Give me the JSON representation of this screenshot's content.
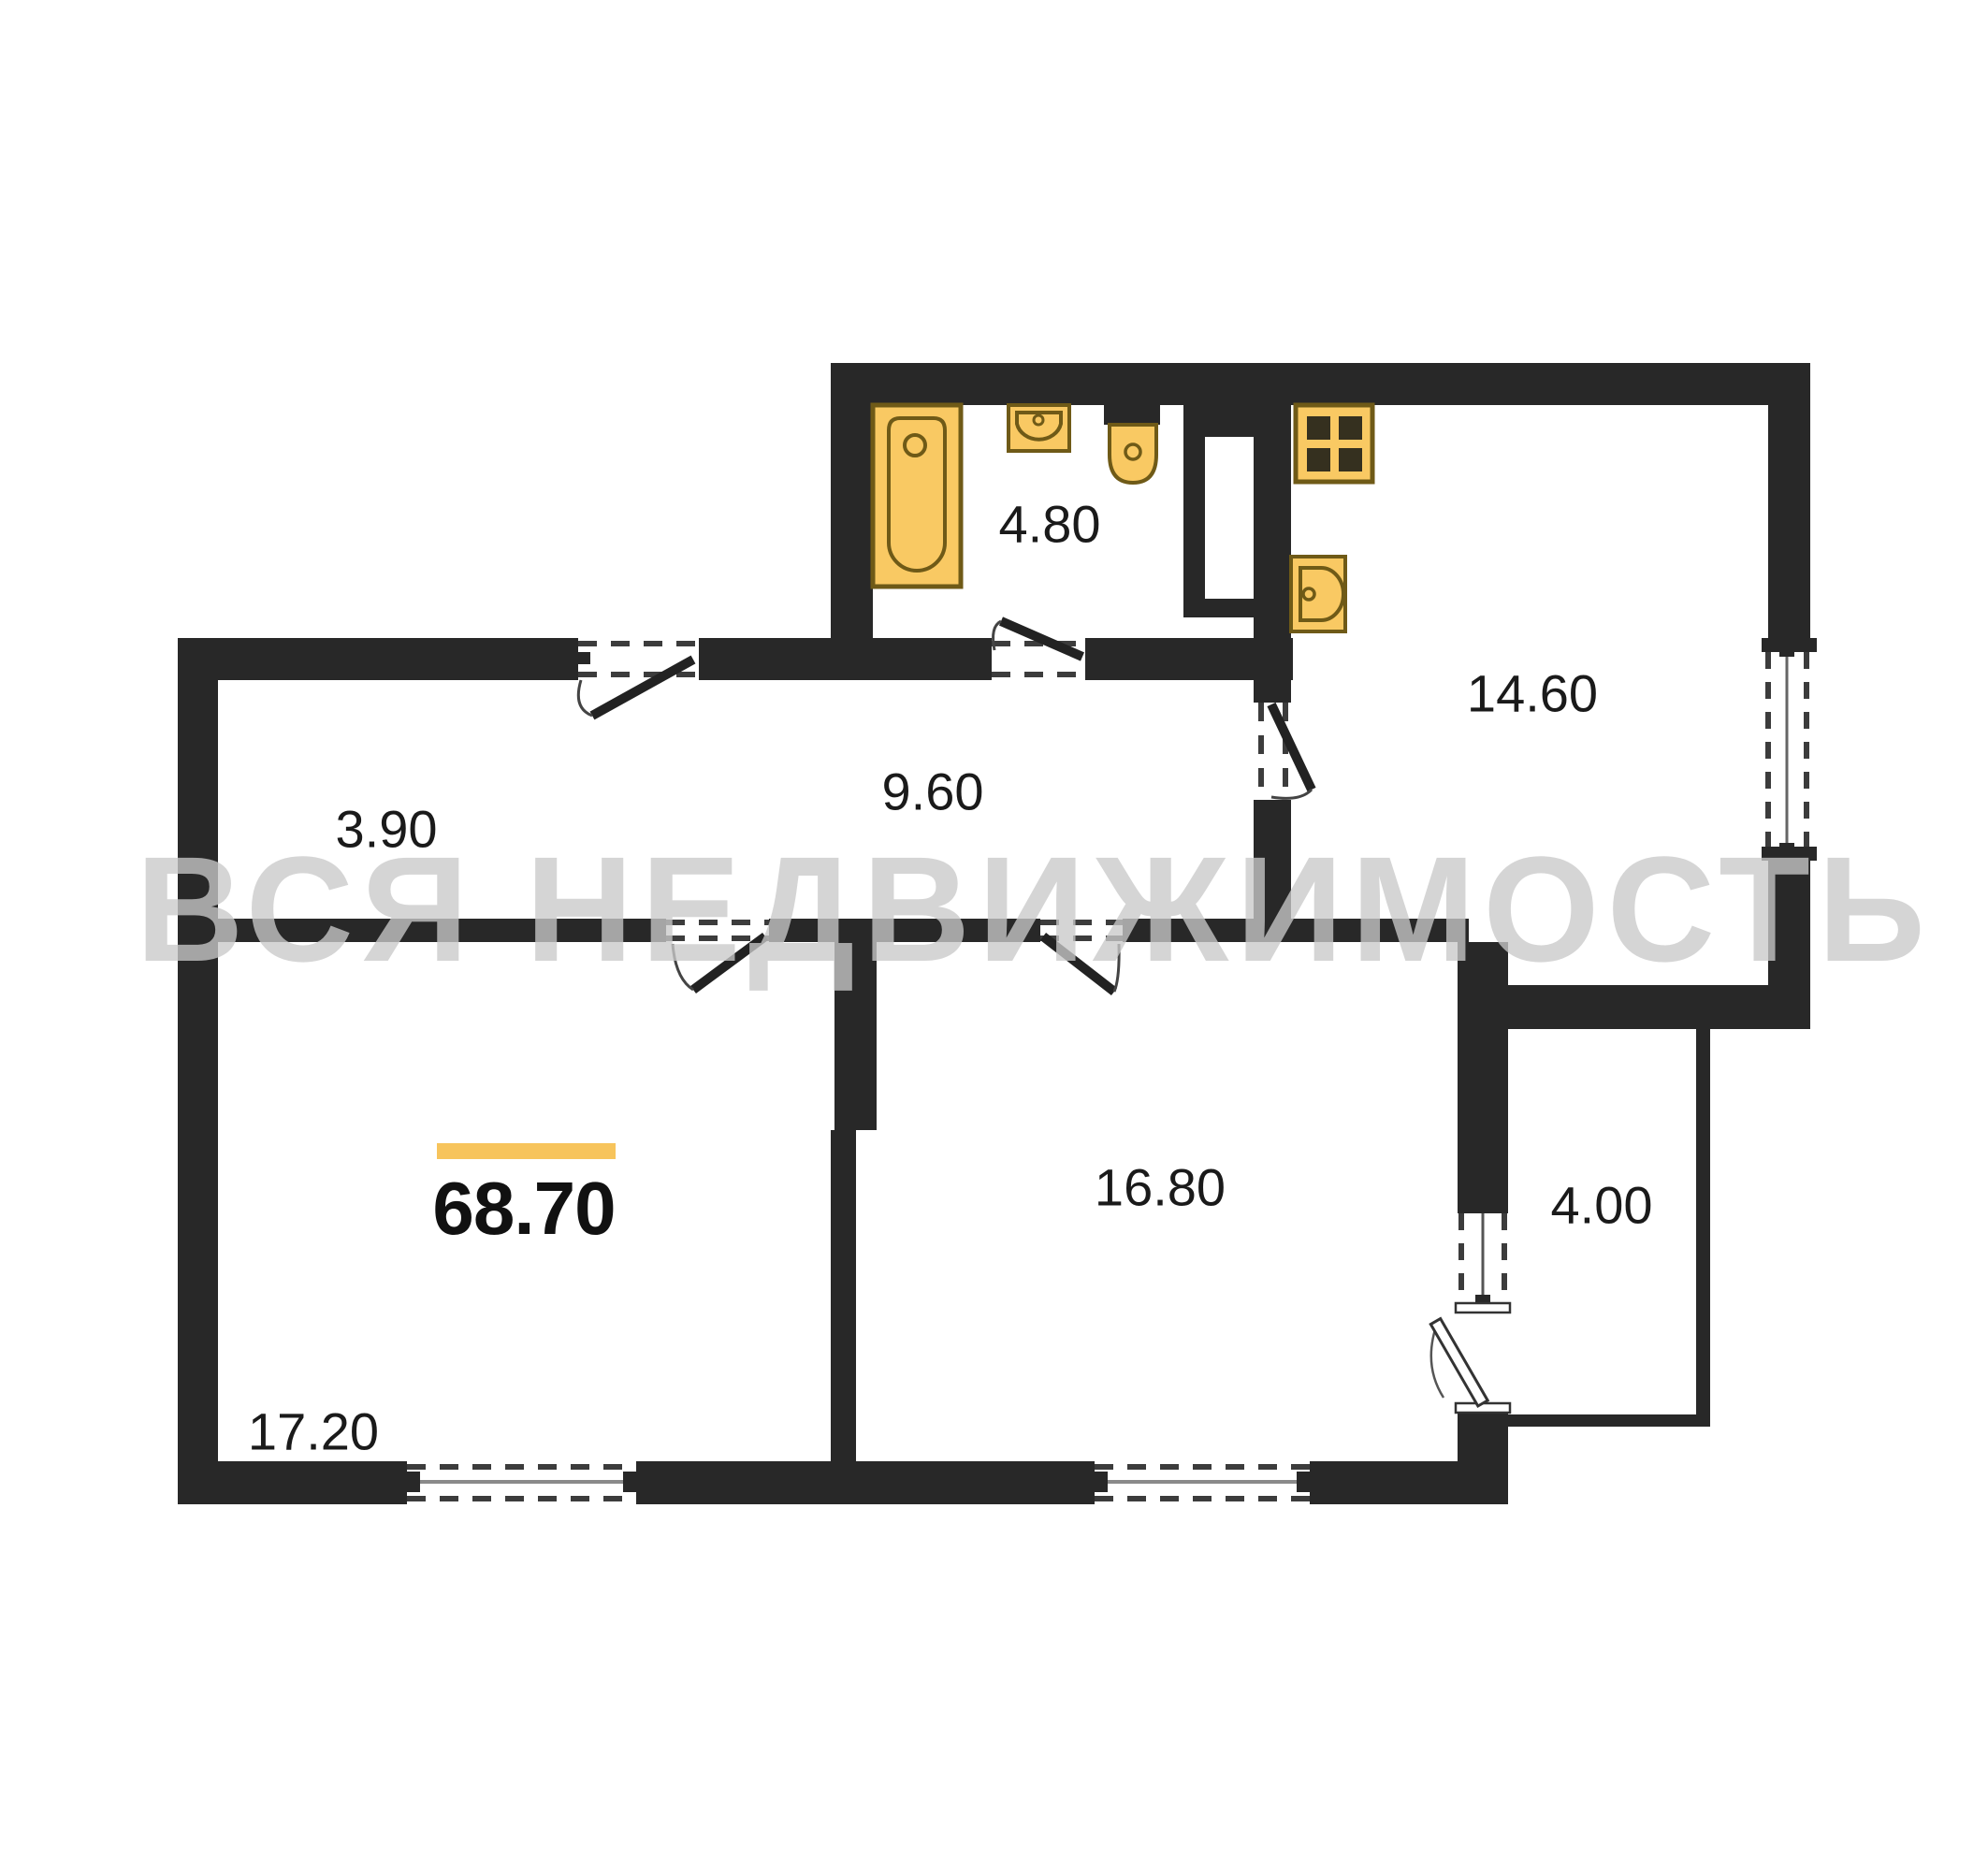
{
  "document": {
    "type": "apartment-floor-plan",
    "watermark_text": "ВСЯ НЕДВИЖИМОСТЬ"
  },
  "total_area": {
    "value": "68.70",
    "accent_bar_color": "#F7C45C"
  },
  "rooms": {
    "entry_hall": {
      "name": "entry-hall",
      "area": "3.90"
    },
    "corridor": {
      "name": "corridor",
      "area": "9.60"
    },
    "bathroom": {
      "name": "bathroom",
      "area": "4.80"
    },
    "kitchen": {
      "name": "kitchen",
      "area": "14.60"
    },
    "bedroom": {
      "name": "bedroom",
      "area": "16.80"
    },
    "living_room": {
      "name": "living-room",
      "area": "17.20"
    },
    "balcony": {
      "name": "balcony",
      "area": "4.00"
    }
  },
  "fixtures": [
    "bathtub-icon",
    "washbasin-icon",
    "toilet-icon",
    "stove-icon",
    "kitchen-sink-icon"
  ],
  "colors": {
    "wall": "#282828",
    "fixture_fill": "#F9C963",
    "fixture_stroke": "#6F5A17",
    "burner": "#35301F",
    "label_text": "#1a1a1a",
    "accent": "#F7C45C",
    "watermark": "#C9C9C9",
    "dash": "#3c3c3c",
    "window_center": "#8a8a8a"
  }
}
